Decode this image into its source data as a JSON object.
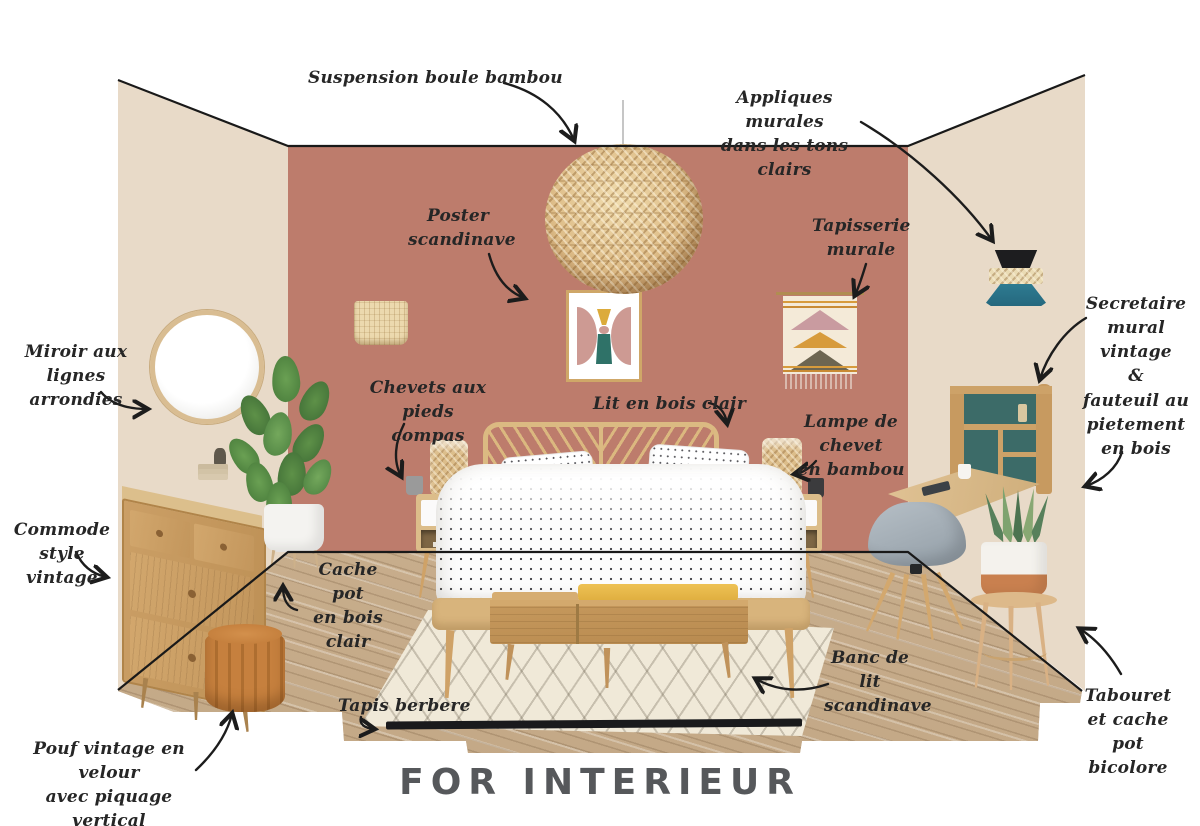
{
  "logo": "FOR INTERIEUR",
  "labels": {
    "suspension": "Suspension boule bambou",
    "appliques": "Appliques murales\ndans les tons clairs",
    "poster": "Poster\nscandinave",
    "tapisserie": "Tapisserie\nmurale",
    "miroir": "Miroir aux lignes\narrondies",
    "chevets": "Chevets aux pieds\ncompas",
    "lit": "Lit en bois clair",
    "lampe": "Lampe de chevet\nen bambou",
    "secretaire": "Secretaire\nmural vintage\n&\nfauteuil au\npietement\nen bois",
    "commode": "Commode\nstyle vintage",
    "cache_pot": "Cache pot\nen bois clair",
    "banc": "Banc de lit\nscandinave",
    "tapis": "Tapis berbere",
    "pouf": "Pouf vintage en velour\navec piquage vertical",
    "tabouret": "Tabouret\net cache pot\nbicolore"
  },
  "colors": {
    "back_wall": "#bd7c6c",
    "side_wall": "#e8dac8",
    "floor_wood": "#c9ae8e",
    "rug": "#f0e9d8",
    "wood": "#c79c62",
    "accent_teal": "#2e7b91",
    "desk_teal": "#3c6b68",
    "mustard": "#e3b54b",
    "pouf_terracotta": "#c6803e",
    "ink": "#1f1f1f",
    "logo_gray": "#56585b"
  }
}
